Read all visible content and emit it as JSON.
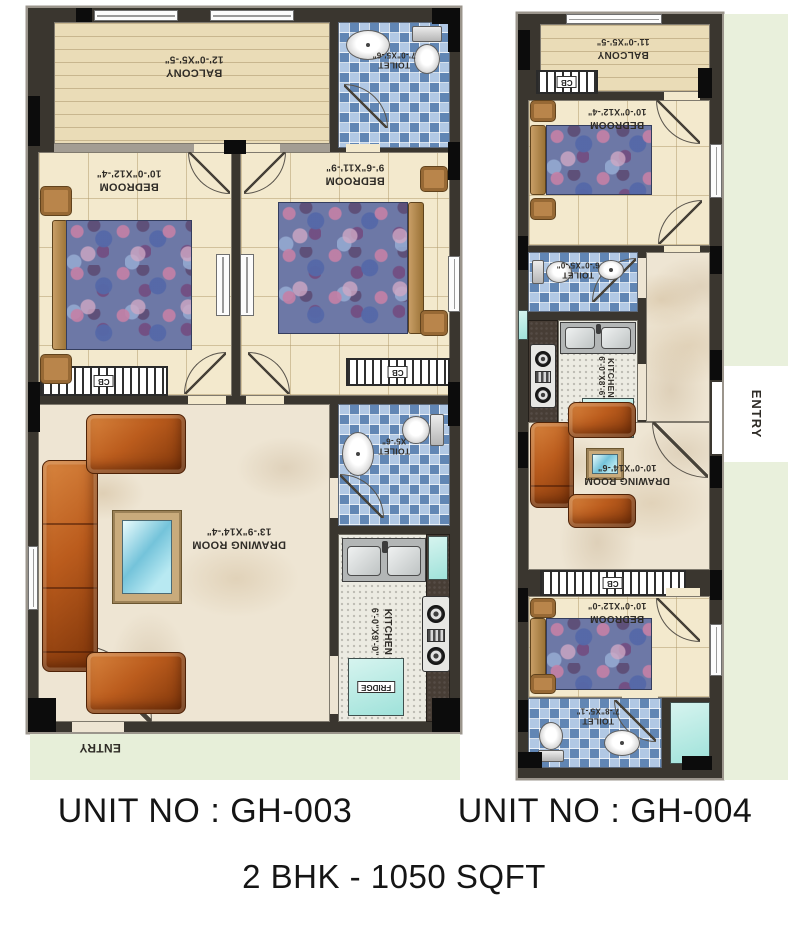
{
  "palette": {
    "wall": "#3a362f",
    "column": "#0c0c0c",
    "floor_tile": "#f3e9cd",
    "balcony_deck": "#eadcb7",
    "toilet_tile": "#9db9da",
    "marble": "#eee5d3",
    "kitchen_floor": "#ecebe2",
    "counter": "#473d35",
    "sofa": "#bb5c1d",
    "bed_fabric": "#6d78a6",
    "wood": "#b9854b",
    "glass": "#9fe2da",
    "outside_green": "#e7efd9",
    "label_text": "#2f2c27"
  },
  "gh003": {
    "balcony": {
      "label": "BALCONY",
      "dim": "12'-0\"X5'-5\""
    },
    "toilet_top": {
      "label": "TOILET",
      "dim": "7'-0\"X5'-6\""
    },
    "bedroom_left": {
      "label": "BEDROOM",
      "dim": "10'-0\"X12'-4\""
    },
    "bedroom_right": {
      "label": "BEDROOM",
      "dim": "9'-6\"X11'-9\""
    },
    "toilet_mid": {
      "label": "TOILET",
      "dim": "X5'-6\""
    },
    "drawing_room": {
      "label": "DRAWING ROOM",
      "dim": "13'-9\"X14'-4\""
    },
    "kitchen": {
      "label": "KITCHEN",
      "dim": "6'-0\"X9'-0\""
    },
    "fridge": "FRIDGE",
    "entry": "ENTRY",
    "cb": "CB"
  },
  "gh004": {
    "balcony": {
      "label": "BALCONY",
      "dim": "11'-0\"X5'-5\""
    },
    "bedroom_top": {
      "label": "BEDROOM",
      "dim": "10'-0\"X12'-4\""
    },
    "toilet_top": {
      "label": "TOILET",
      "dim": "6'-0\"X5'-0\""
    },
    "kitchen": {
      "label": "KITCHEN",
      "dim": "6'-0\"X8'-6\""
    },
    "fridge": "FRIDGE",
    "drawing_room": {
      "label": "DRAWING ROOM",
      "dim": "10'-0\"X14'-6\""
    },
    "bedroom_bottom": {
      "label": "BEDROOM",
      "dim": "10'-0\"X12'-0\""
    },
    "toilet_bottom": {
      "label": "TOILET",
      "dim": "7'-8\"X5'-1\""
    },
    "entry": "ENTRY",
    "cb": "CB"
  },
  "footer": {
    "unit_left": "UNIT NO : GH-003",
    "unit_right": "UNIT NO : GH-004",
    "subtitle": "2 BHK - 1050 SQFT"
  }
}
